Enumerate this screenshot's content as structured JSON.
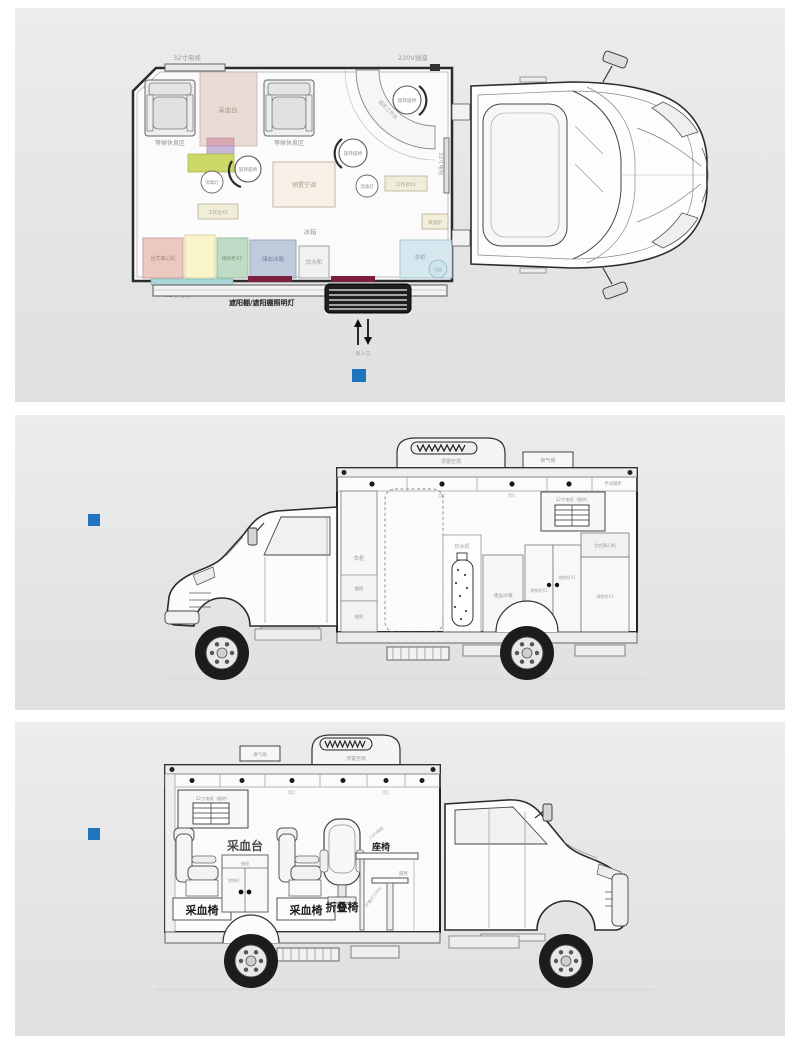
{
  "colors": {
    "accent": "#1f74bd",
    "maroon_strip": "#7d1f3f",
    "teal_strip": "#abd7db"
  },
  "floor_plan": {
    "tv_top": "32寸电视",
    "socket_220v": "220V插座",
    "waiting_area": "等候休息区",
    "blood_collection_table": "采血台",
    "rotating_seat": "旋转座椅",
    "disinfection_lamp": "消毒灯",
    "reserved_ac": "预置空调",
    "worktable_x1": "工作台X1",
    "arc_worktable": "弧形工作台",
    "tv_right": "32寸电视",
    "microwave": "微波炉",
    "fridge": "冰箱",
    "centrifuge": "台式离心机",
    "storage_x2": "储物柜X2",
    "blood_fridge": "储血冰箱",
    "water_dispenser": "饮水机",
    "wardrobe": "衣柜",
    "trash": "垃圾",
    "tv_bottom": "32寸电视",
    "awning": "遮阳棚/遮阳棚照明灯",
    "entrance": "出入口"
  },
  "side_left": {
    "roof_ac": "顶置空调",
    "vent_fan": "换气扇",
    "manual_step": "手动踏步",
    "downlight": "筒灯",
    "wardrobe": "衣柜",
    "drawer": "抽屉",
    "water_dispenser": "饮水机",
    "blood_fridge": "储血冰箱",
    "storage_x1": "储物柜X1",
    "centrifuge": "台式离心机",
    "tv_flip": "32寸电视（翻转）"
  },
  "side_right": {
    "vent_fan": "换气扇",
    "roof_ac": "顶置空调",
    "downlight": "筒灯",
    "tv_flip": "32寸电视（翻转）",
    "blood_table": "采血台",
    "blood_chair": "采血椅",
    "drawer": "抽屉",
    "storage": "储物柜",
    "folding_chair": "折叠椅",
    "seat": "座椅",
    "socket_220v": "220V插座",
    "stool": "圆凳",
    "folding_worktable": "折叠式工作台"
  }
}
